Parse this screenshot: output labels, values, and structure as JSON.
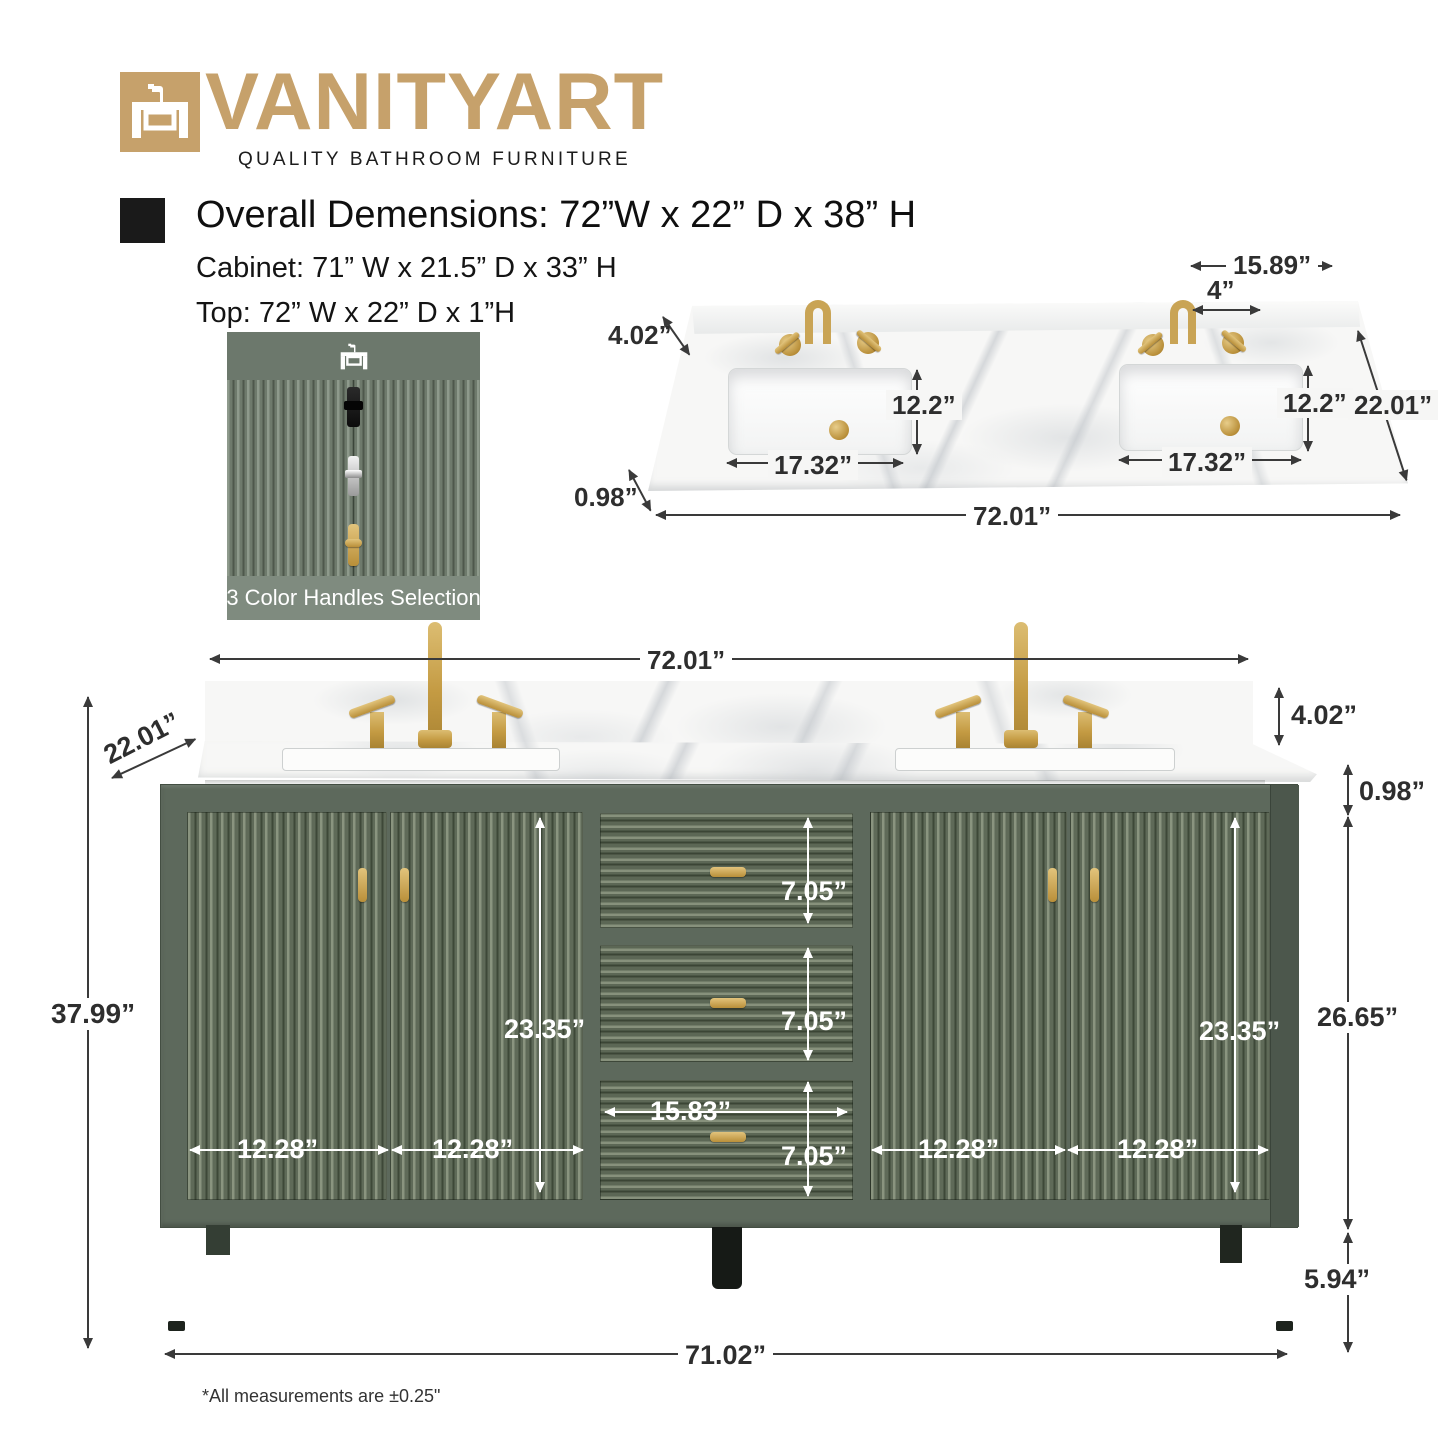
{
  "brand": {
    "name": "VANITYART",
    "tagline": "QUALITY BATHROOM FURNITURE"
  },
  "specs": {
    "overall": "Overall Demensions: 72”W x 22” D x 38” H",
    "cabinet": "Cabinet: 71” W x 21.5” D x 33” H",
    "top": "Top: 72” W x 22” D x 1”H"
  },
  "swatch": {
    "caption": "3 Color Handles Selection",
    "handles": [
      "black-handle",
      "chrome-handle",
      "gold-handle"
    ]
  },
  "top_view": {
    "faucet_spread": "15.89”",
    "hole_spacing": "4”",
    "backsplash_height": "4.02”",
    "sink_depth_left": "12.2”",
    "sink_depth_right": "12.2”",
    "sink_width_left": "17.32”",
    "sink_width_right": "17.32”",
    "counter_thickness": "0.98”",
    "depth": "22.01”",
    "width": "72.01”"
  },
  "front_view": {
    "width": "72.01”",
    "depth": "22.01”",
    "backsplash_height": "4.02”",
    "counter_thickness": "0.98”",
    "overall_height": "37.99”",
    "door_height_left": "23.35”",
    "door_height_right": "23.35”",
    "drawer_heights": [
      "7.05”",
      "7.05”",
      "7.05”"
    ],
    "drawer_width": "15.83”",
    "door_widths": [
      "12.28”",
      "12.28”",
      "12.28”",
      "12.28”"
    ],
    "body_height": "26.65”",
    "leg_height": "5.94”",
    "base_width": "71.02”"
  },
  "footnote": "*All measurements are ±0.25\"",
  "colors": {
    "brand_gold": "#c6a16b",
    "cabinet_green": "#5d695c",
    "hardware_gold": "#c9a455",
    "dimension_text": "#2e2e2e"
  }
}
